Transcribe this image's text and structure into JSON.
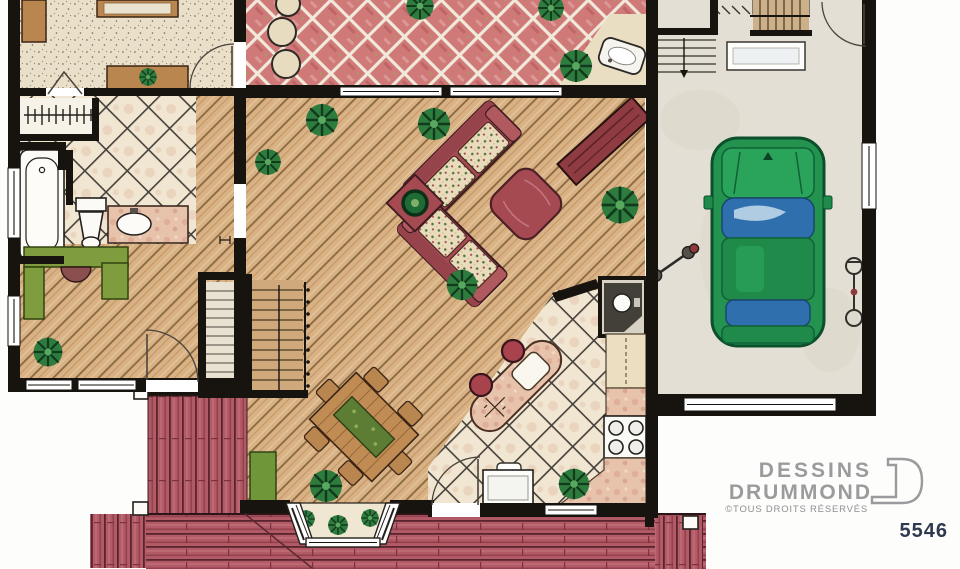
{
  "branding": {
    "name_line1": "DESSINS",
    "name_line2": "DRUMMOND",
    "rights": "©TOUS DROITS RÉSERVÉS",
    "plan_number": "5546"
  },
  "palette": {
    "paper": "#fdfdfc",
    "wall": "#17130f",
    "carpet": "#eae0c9",
    "patio_tile": "#cf7a78",
    "walkway": "#e9dec2",
    "wood_floor": "#d8b184",
    "wood_line": "#8a6840",
    "deck_red": "#b25a66",
    "deck_dark": "#58242e",
    "kitchen_tile": "#f0e6d2",
    "tile_grout": "#46403a",
    "garage_floor": "#e4dfd4",
    "car_green": "#23934f",
    "car_glass": "#2f6fae",
    "sofa_red": "#a64a52",
    "floral_cream": "#e9dcbd",
    "marble_pink": "#e8c3ac",
    "desk_green": "#7f9d3f",
    "bench_green": "#6f9638",
    "plant_green": "#2e7b3e",
    "logo_gray": "#9b9b9d",
    "plan_number_color": "#2e3950"
  }
}
